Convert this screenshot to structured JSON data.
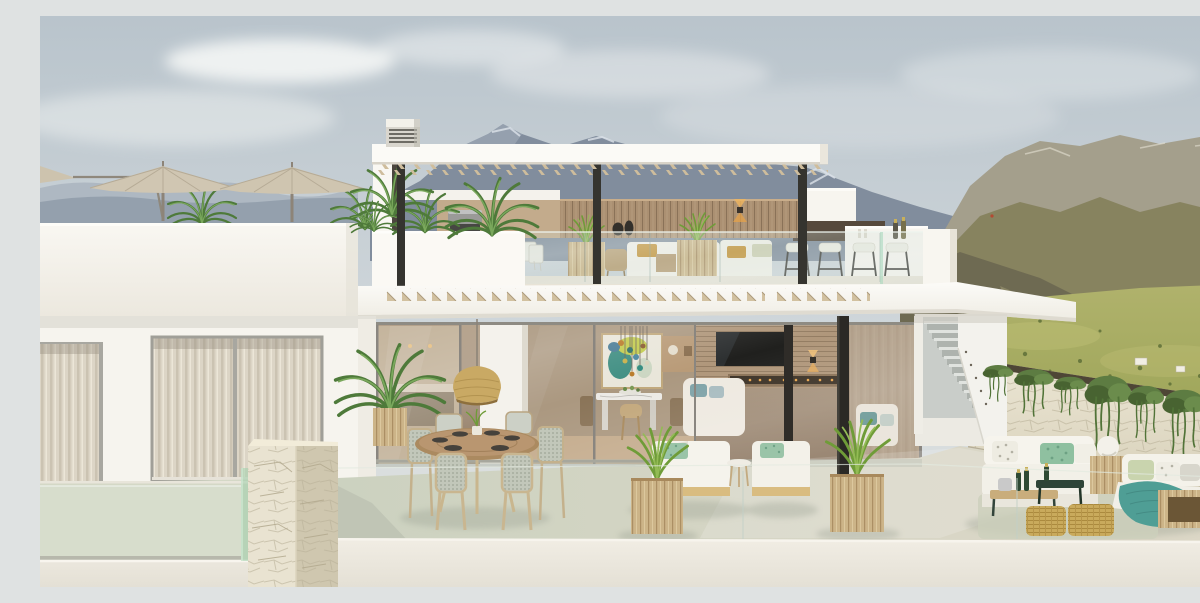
{
  "scene": {
    "type": "architectural-rendering",
    "title": "Modern two-storey white villa with rooftop pergola terrace and mountain views",
    "caption": "Daylight rendering of a contemporary white villa: rooftop lounge under a slatted pergola with bar stools and palms, a lower terrace with round outdoor dining table, rattan pendant lamp, sun loungers and a white modular lounge sofa, an exterior staircase, a stone retaining wall draped with ivy, beige parasols on a side terrace, and layered blue and olive mountains with a green meadow behind.",
    "time_of_day": "day"
  },
  "sky": {
    "clouds": 5,
    "top_color": "#b9c4cc",
    "horizon_color": "#e3e5e2"
  },
  "mountains": {
    "left_ridge_color": "#94a0ad",
    "center_ridge_color": "#818d9d",
    "right_ridge_color": "#87835f",
    "meadow_color": "#a9b062",
    "snow_patches": true,
    "tiny_red_flag": true,
    "farm_buildings": 2
  },
  "villa": {
    "wall_color": "#f7f5f0",
    "rooftop": {
      "pergola_slatted_roof": true,
      "dark_posts": 3,
      "vent_cube": true,
      "wood_feature_wall_color": "#a98e70",
      "bbq_grill": true,
      "wall_sconce": true,
      "decor_vases": 2,
      "palms": 3,
      "grass_planters": 2,
      "white_sofa_pillow_colors": [
        "#c59439",
        "#cfd0b4"
      ],
      "bar_stools": 4,
      "champagne_bottles_on_bar": 2,
      "glass_railing": true
    },
    "left_terrace": {
      "parasols": 2,
      "palm_clusters": 2
    },
    "main_floor": {
      "curtained_windows": 2,
      "glass_sliding_doors": true,
      "interior": {
        "abstract_artwork": true,
        "glass_pendant_lights": 8,
        "marble_dining_table": true,
        "tv_on_wood_slat_wall": true,
        "linear_fireplace": true,
        "white_sofa_pillow_color": "#7fa3a8",
        "wall_sconce": true
      },
      "exterior_staircase_steps": 11
    }
  },
  "terrace": {
    "floor_color": "#d2d6c4",
    "round_dining_table": {
      "seats": 6,
      "wood_color": "#ab8a60",
      "place_settings": 6
    },
    "rattan_pendant_lamp_color": "#c9a964",
    "potted_palm": 1,
    "sun_loungers": 2,
    "lounger_pillow_color": "#9ac4a8",
    "grass_planters": 2,
    "lounge_set": {
      "white_modular_sofa": true,
      "wicker_ottomans": 2,
      "teal_throw_color": "#4f9e95",
      "pillow_colors": [
        "#8fc0a0",
        "#c9d4ae",
        "#ffffff"
      ],
      "sphere_lamp": true,
      "dark_green_coffee_table": true,
      "champagne_bottles": 3,
      "ice_bucket": true,
      "wood_cube_tables": 2
    },
    "glass_balustrade": true,
    "stone_clad_pillar": true
  },
  "landscape": {
    "stone_wall_with_ivy": true,
    "ivy_color": "#5d7c42",
    "stone_color": "#e7e1cf"
  }
}
